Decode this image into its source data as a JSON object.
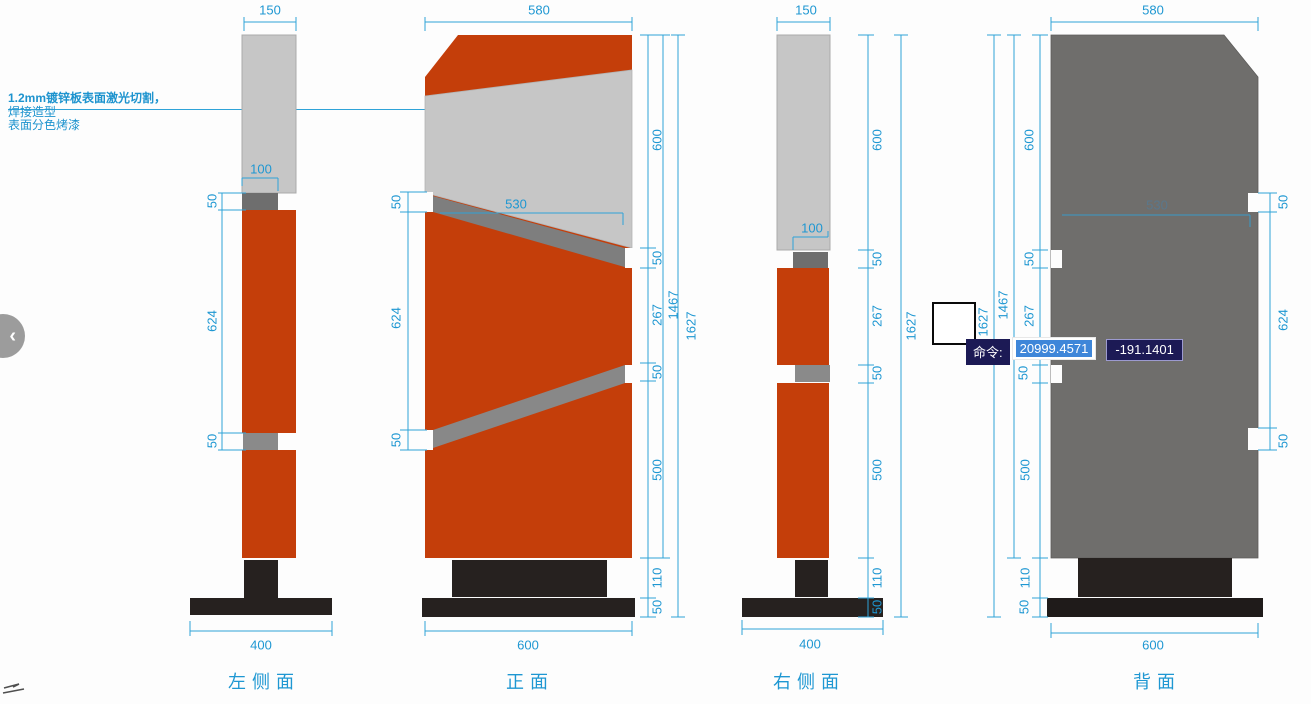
{
  "annotation": {
    "line1": "1.2mm镀锌板表面激光切割，",
    "line2": "焊接造型",
    "line3": "表面分色烤漆"
  },
  "nav": {
    "prev_icon": "‹"
  },
  "command_overlay": {
    "prompt": "命令:",
    "x_value": "20999.4571",
    "y_value": "-191.1401"
  },
  "view_titles": [
    {
      "text": "左侧面",
      "x": 264,
      "y": 681
    },
    {
      "text": "正面",
      "x": 530,
      "y": 681
    },
    {
      "text": "右侧面",
      "x": 809,
      "y": 681
    },
    {
      "text": "背面",
      "x": 1157,
      "y": 681
    }
  ],
  "dim_labels": [
    {
      "text": "150",
      "x": 270,
      "y": 10
    },
    {
      "text": "580",
      "x": 539,
      "y": 10
    },
    {
      "text": "150",
      "x": 806,
      "y": 10
    },
    {
      "text": "580",
      "x": 1153,
      "y": 10
    },
    {
      "text": "100",
      "x": 261,
      "y": 169
    },
    {
      "text": "50",
      "x": 212,
      "y": 201,
      "rot": 1
    },
    {
      "text": "624",
      "x": 212,
      "y": 321,
      "rot": 1
    },
    {
      "text": "50",
      "x": 212,
      "y": 441,
      "rot": 1
    },
    {
      "text": "400",
      "x": 261,
      "y": 645
    },
    {
      "text": "530",
      "x": 516,
      "y": 204
    },
    {
      "text": "50",
      "x": 396,
      "y": 202,
      "rot": 1
    },
    {
      "text": "624",
      "x": 396,
      "y": 318,
      "rot": 1
    },
    {
      "text": "50",
      "x": 396,
      "y": 440,
      "rot": 1
    },
    {
      "text": "600",
      "x": 657,
      "y": 140,
      "rot": 1
    },
    {
      "text": "50",
      "x": 657,
      "y": 258,
      "rot": 1
    },
    {
      "text": "267",
      "x": 657,
      "y": 315,
      "rot": 1
    },
    {
      "text": "50",
      "x": 657,
      "y": 372,
      "rot": 1
    },
    {
      "text": "500",
      "x": 657,
      "y": 470,
      "rot": 1
    },
    {
      "text": "110",
      "x": 657,
      "y": 578,
      "rot": 1
    },
    {
      "text": "50",
      "x": 657,
      "y": 607,
      "rot": 1
    },
    {
      "text": "1467",
      "x": 673,
      "y": 305,
      "rot": 1
    },
    {
      "text": "1627",
      "x": 691,
      "y": 326,
      "rot": 1
    },
    {
      "text": "600",
      "x": 528,
      "y": 645
    },
    {
      "text": "100",
      "x": 812,
      "y": 228
    },
    {
      "text": "600",
      "x": 877,
      "y": 140,
      "rot": 1
    },
    {
      "text": "50",
      "x": 877,
      "y": 259,
      "rot": 1
    },
    {
      "text": "267",
      "x": 877,
      "y": 316,
      "rot": 1
    },
    {
      "text": "50",
      "x": 877,
      "y": 373,
      "rot": 1
    },
    {
      "text": "500",
      "x": 877,
      "y": 470,
      "rot": 1
    },
    {
      "text": "110",
      "x": 877,
      "y": 578,
      "rot": 1
    },
    {
      "text": "50",
      "x": 877,
      "y": 607,
      "rot": 1
    },
    {
      "text": "1627",
      "x": 911,
      "y": 326,
      "rot": 1
    },
    {
      "text": "400",
      "x": 810,
      "y": 644
    },
    {
      "text": "530",
      "x": 1157,
      "y": 205,
      "faint": 1
    },
    {
      "text": "600",
      "x": 1029,
      "y": 140,
      "rot": 1
    },
    {
      "text": "50",
      "x": 1029,
      "y": 259,
      "rot": 1
    },
    {
      "text": "267",
      "x": 1029,
      "y": 316,
      "rot": 1
    },
    {
      "text": "50",
      "x": 1023,
      "y": 373,
      "rot": 1
    },
    {
      "text": "500",
      "x": 1025,
      "y": 470,
      "rot": 1
    },
    {
      "text": "110",
      "x": 1025,
      "y": 578,
      "rot": 1
    },
    {
      "text": "50",
      "x": 1024,
      "y": 607,
      "rot": 1
    },
    {
      "text": "1467",
      "x": 1003,
      "y": 305,
      "rot": 1
    },
    {
      "text": "1627",
      "x": 983,
      "y": 322,
      "rot": 1
    },
    {
      "text": "50",
      "x": 1283,
      "y": 202,
      "rot": 1
    },
    {
      "text": "624",
      "x": 1283,
      "y": 320,
      "rot": 1
    },
    {
      "text": "50",
      "x": 1283,
      "y": 441,
      "rot": 1
    },
    {
      "text": "600",
      "x": 1153,
      "y": 645
    }
  ],
  "colors": {
    "dimension_blue": "#1e97d2",
    "orange": "#c43e0a",
    "panel_light_gray": "#c6c6c6",
    "strip_gray": "#7e7e7e",
    "back_panel_gray": "#6f6e6c",
    "base_black": "#26211f",
    "command_navy": "#1c1a55",
    "selection_blue": "#3e86d9"
  }
}
